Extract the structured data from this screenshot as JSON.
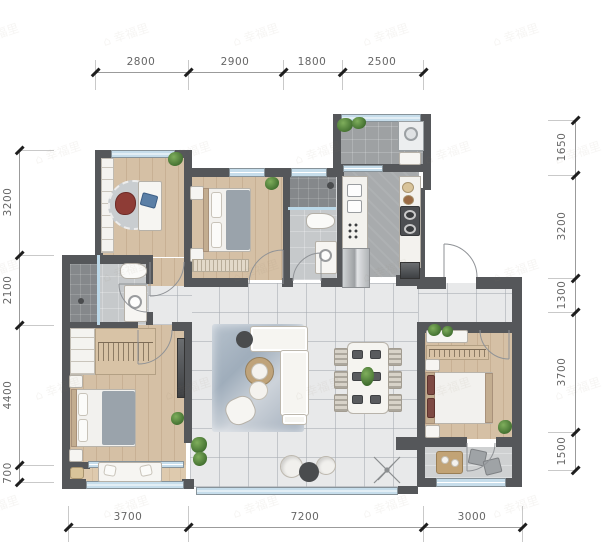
{
  "watermark": {
    "logo": "⌂",
    "text": "幸福里"
  },
  "dimensions": {
    "top": [
      "2800",
      "2900",
      "1800",
      "2500"
    ],
    "left": [
      "3200",
      "2100",
      "4400",
      "700"
    ],
    "right": [
      "1650",
      "3200",
      "1300",
      "3700",
      "1500"
    ],
    "bottom": [
      "3700",
      "7200",
      "3000"
    ]
  },
  "colors": {
    "wall": "#55575a",
    "window_glass": "#c6ddeb",
    "wood_floor": "#d5c0a5",
    "tile_floor": "#e8e9ea",
    "rug": "#a9b5c3",
    "dimension_text": "#666666"
  }
}
